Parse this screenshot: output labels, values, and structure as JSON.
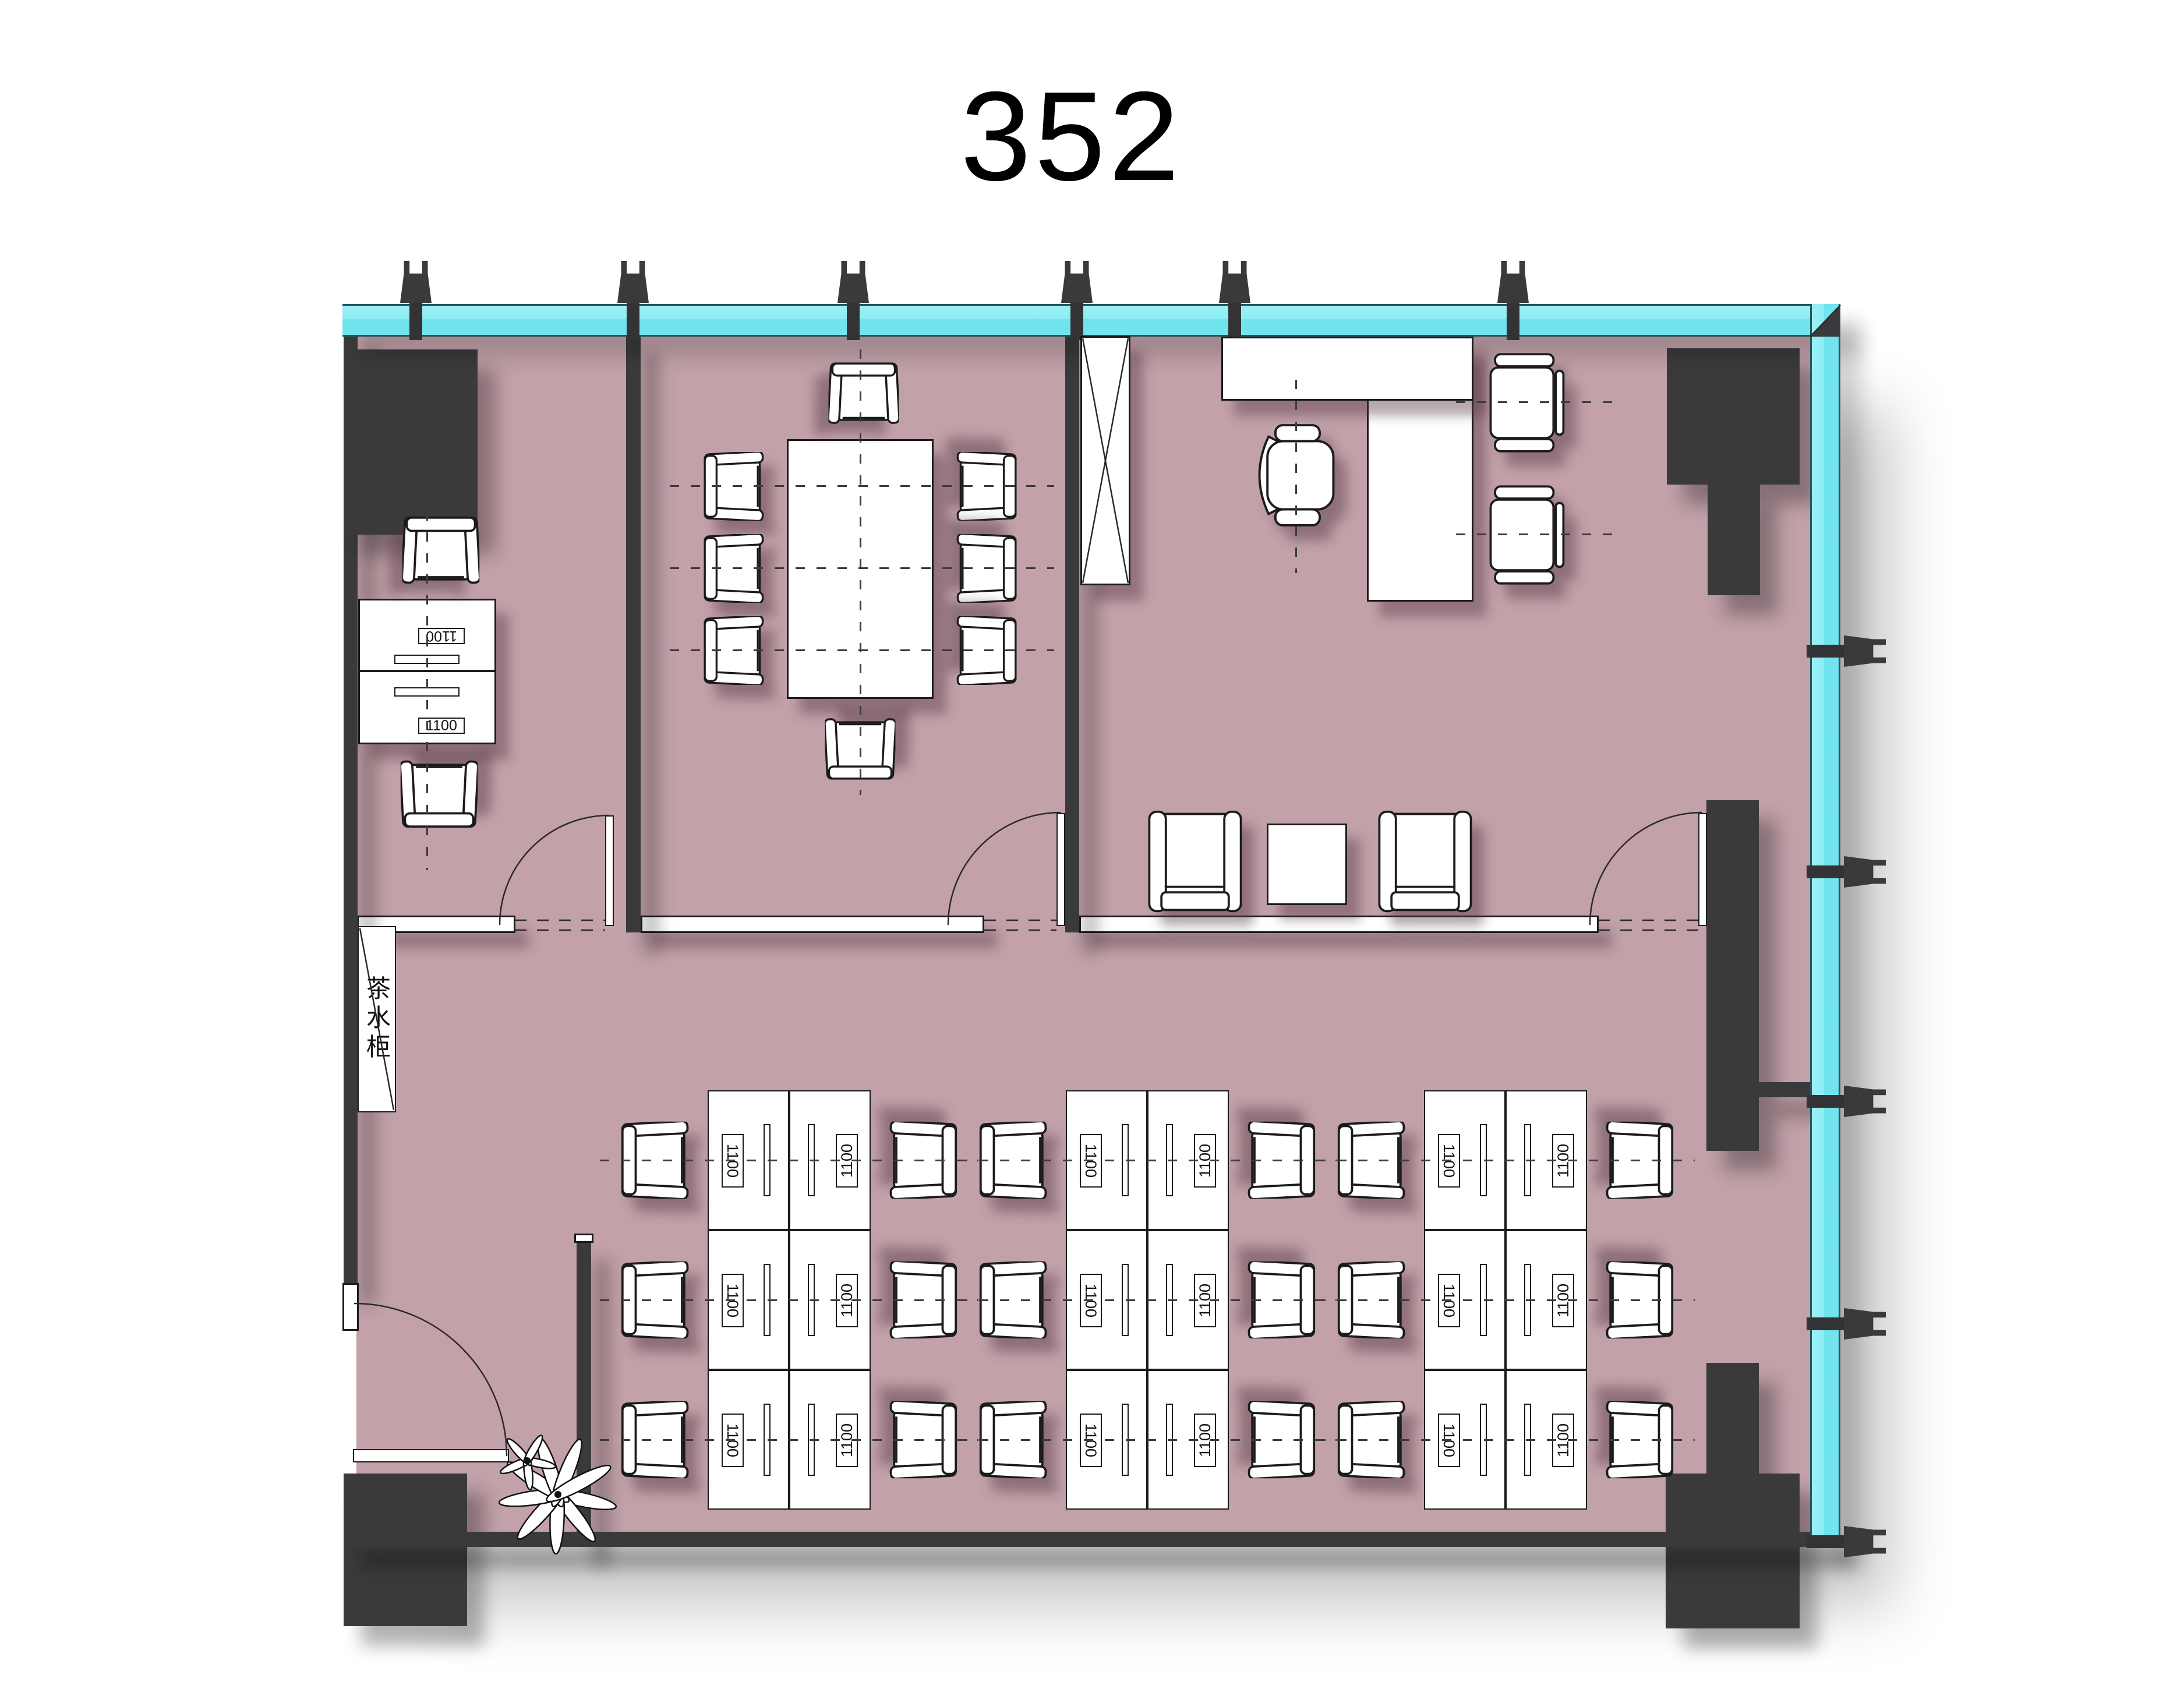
{
  "title": "352",
  "labels": {
    "desk_length": "1100",
    "tea_cabinet": "茶水柜"
  },
  "colors": {
    "floor": "#c2a1a9",
    "wall": "#3a3a3c",
    "glass": "#7fe9f2",
    "glass_edge": "#27565c",
    "outline": "#1b1b1b",
    "paper": "#ffffff"
  },
  "furniture": {
    "left_room_desk_labels": [
      "1100",
      "1100"
    ],
    "workstation_clusters": 3,
    "desks_per_cluster": 6,
    "workstation_desk_label": "1100",
    "conference_seats": 8,
    "office_guest_chairs": 2,
    "lounge_chairs": 2
  }
}
